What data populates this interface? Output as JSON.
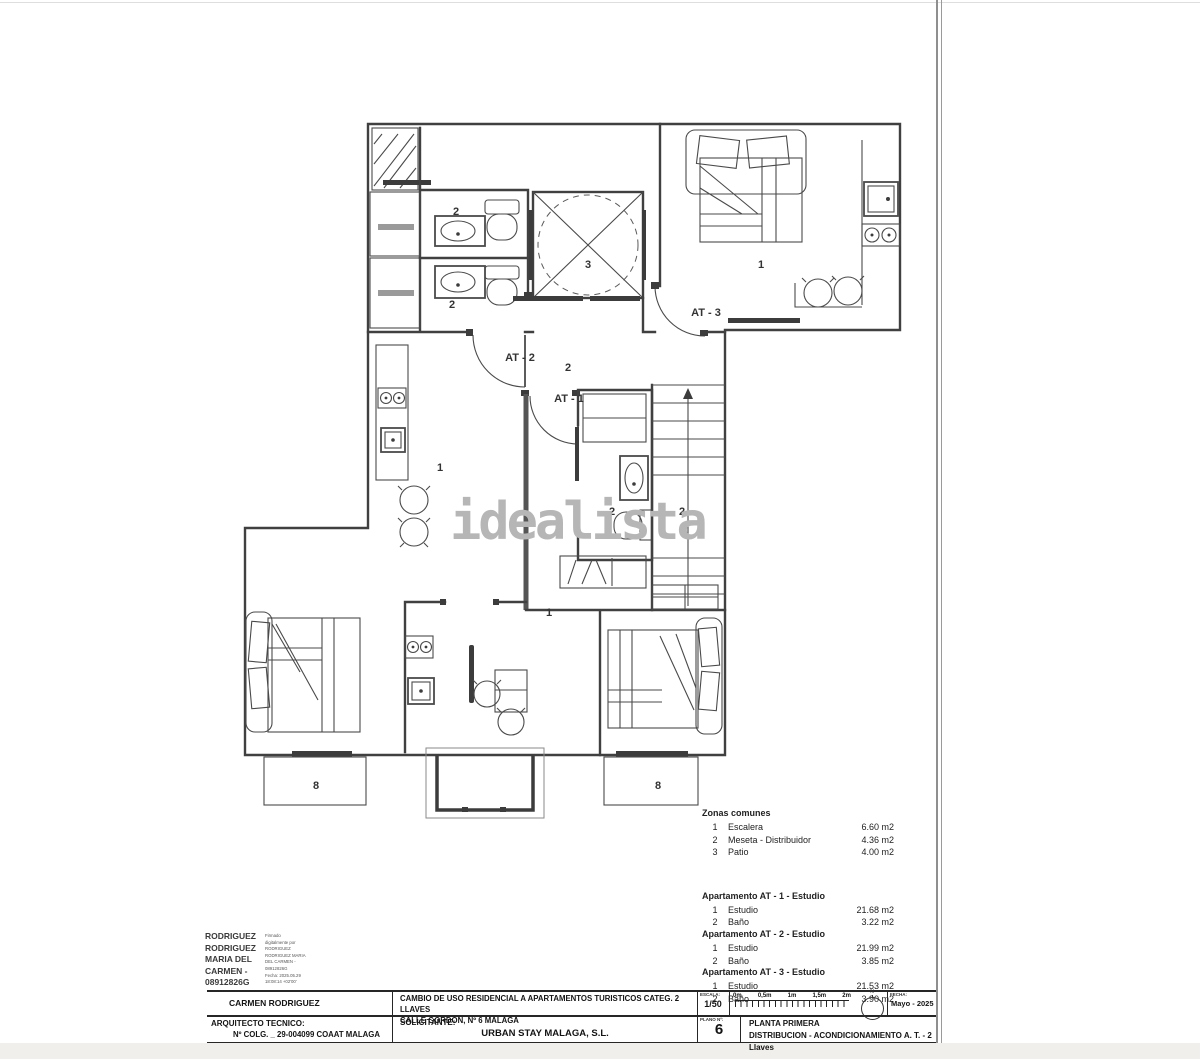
{
  "watermark": "idealista",
  "plan": {
    "labels": [
      {
        "text": "2",
        "x": 456,
        "y": 215
      },
      {
        "text": "2",
        "x": 452,
        "y": 308
      },
      {
        "text": "3",
        "x": 588,
        "y": 268
      },
      {
        "text": "1",
        "x": 761,
        "y": 268
      },
      {
        "text": "AT - 3",
        "x": 706,
        "y": 316
      },
      {
        "text": "AT - 2",
        "x": 520,
        "y": 361
      },
      {
        "text": "2",
        "x": 568,
        "y": 371
      },
      {
        "text": "AT - 1",
        "x": 569,
        "y": 402
      },
      {
        "text": "1",
        "x": 440,
        "y": 471
      },
      {
        "text": "2",
        "x": 612,
        "y": 515
      },
      {
        "text": "2",
        "x": 682,
        "y": 515
      },
      {
        "text": "1",
        "x": 549,
        "y": 616
      },
      {
        "text": "8",
        "x": 316,
        "y": 789
      },
      {
        "text": "8",
        "x": 658,
        "y": 789
      }
    ]
  },
  "legend": {
    "zonas": {
      "title": "Zonas comunes",
      "rows": [
        {
          "num": "1",
          "name": "Escalera",
          "area": "6.60 m2"
        },
        {
          "num": "2",
          "name": "Meseta - Distribuidor",
          "area": "4.36 m2"
        },
        {
          "num": "3",
          "name": "Patio",
          "area": "4.00 m2"
        }
      ]
    },
    "apartments": [
      {
        "title": "Apartamento AT - 1 - Estudio",
        "rows": [
          {
            "num": "1",
            "name": "Estudio",
            "area": "21.68 m2"
          },
          {
            "num": "2",
            "name": "Baño",
            "area": "3.22 m2"
          }
        ]
      },
      {
        "title": "Apartamento AT - 2 - Estudio",
        "rows": [
          {
            "num": "1",
            "name": "Estudio",
            "area": "21.99 m2"
          },
          {
            "num": "2",
            "name": "Baño",
            "area": "3.85 m2"
          }
        ]
      },
      {
        "title": "Apartamento AT - 3 - Estudio",
        "rows": [
          {
            "num": "1",
            "name": "Estudio",
            "area": "21.53 m2"
          },
          {
            "num": "2",
            "name": "Baño",
            "area": "3.90 m2"
          }
        ]
      }
    ]
  },
  "signature": {
    "bold_lines": [
      "RODRIGUEZ",
      "RODRIGUEZ",
      "MARIA DEL",
      "CARMEN -",
      "08912826G"
    ],
    "small_lines": [
      "Firmado",
      "digitalmente por",
      "RODRIGUEZ",
      "RODRIGUEZ MARIA",
      "DEL CARMEN -",
      "08912826G",
      "Fecha: 2025.05.29",
      "18:08:14 +02'00'"
    ]
  },
  "titleblock": {
    "author": "CARMEN RODRIGUEZ",
    "project_line1": "CAMBIO DE USO RESIDENCIAL A APARTAMENTOS TURISTICOS CATEG. 2 LLAVES",
    "project_line2": "CALLE GORDON, Nº 6  MALAGA",
    "escala_label": "ESCALA:",
    "escala_value": "1/50",
    "scale_ticks": [
      "0m",
      "0,5m",
      "1m",
      "1,5m",
      "2m"
    ],
    "north_label": "N",
    "fecha_label": "FECHA:",
    "fecha_value": "Mayo - 2025",
    "arquitecto_label": "ARQUITECTO TECNICO:",
    "arquitecto_value": "Nº COLG. _ 29-004099  COAAT MALAGA",
    "solicitante_label": "SOLICITANTE:",
    "solicitante_value": "URBAN STAY MALAGA, S.L.",
    "plano_label": "PLANO Nº:",
    "plano_value": "6",
    "plano_title1": "PLANTA PRIMERA",
    "plano_title2": "DISTRIBUCION - ACONDICIONAMIENTO A. T. - 2 Llaves"
  }
}
